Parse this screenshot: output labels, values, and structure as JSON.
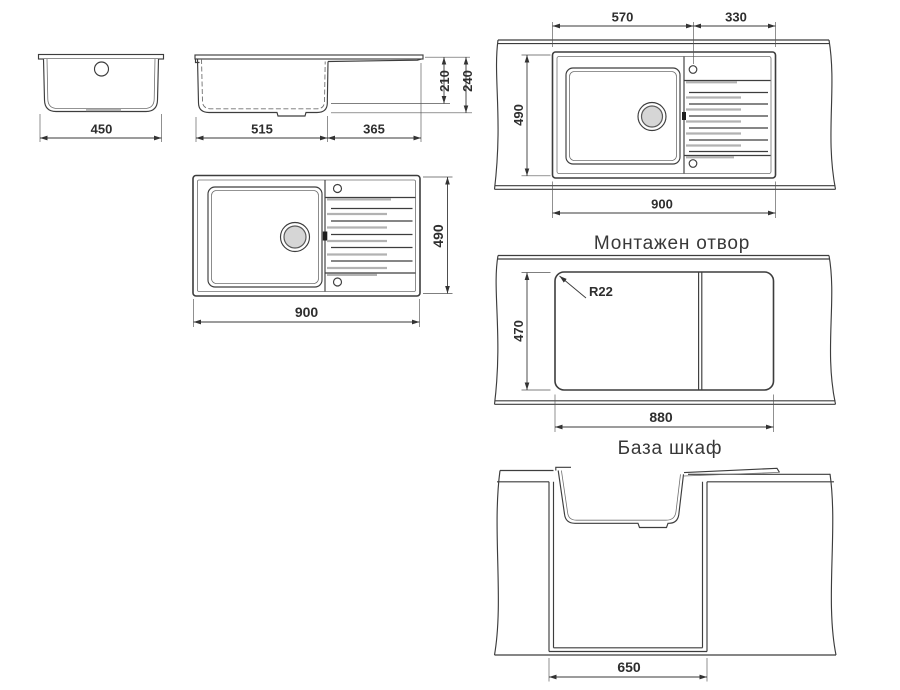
{
  "colors": {
    "line-color": "#3d3d3d",
    "thin-color": "#707070",
    "ext-color": "#555555",
    "dim-color": "#3a3a3a",
    "rib-gray": "#b2b2b2",
    "drain-fill": "#d6d6d6",
    "text-color": "#2e2e2e",
    "bg-color": "#ffffff"
  },
  "views": {
    "front": {
      "width": "450"
    },
    "side": {
      "basin_length": "515",
      "drainboard_length": "365",
      "basin_depth": "210",
      "overall_depth": "240"
    },
    "top": {
      "length": "900",
      "width": "490"
    },
    "countertop_top": {
      "basin_span": "570",
      "drainboard_span": "330",
      "width": "490",
      "length": "900"
    },
    "cutout": {
      "title": "Монтажен отвор",
      "corner_radius": "R22",
      "width": "470",
      "length": "880"
    },
    "cabinet": {
      "title": "База шкаф",
      "inner_width": "650"
    }
  }
}
